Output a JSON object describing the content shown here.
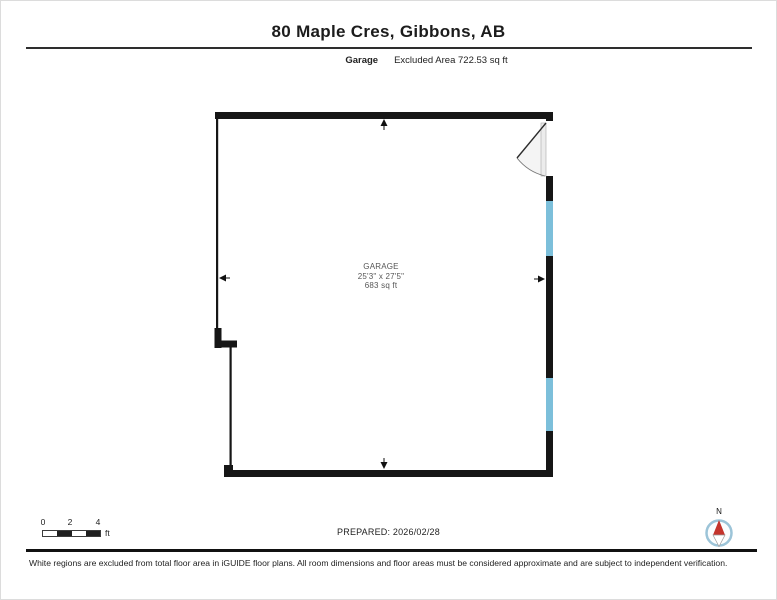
{
  "header": {
    "title": "80 Maple Cres, Gibbons, AB",
    "floor_label": "Garage",
    "area_note": "Excluded Area 722.53 sq ft"
  },
  "room": {
    "name": "GARAGE",
    "dimensions": "25'3\" x 27'5\"",
    "area": "683 sq ft"
  },
  "scale_bar": {
    "ticks": [
      "0",
      "2",
      "4"
    ],
    "unit": "ft"
  },
  "footer": {
    "prepared": "PREPARED: 2026/02/28",
    "disclaimer": "White regions are excluded from total floor area in iGUIDE floor plans. All room dimensions and floor areas must be considered approximate and are subject to independent verification."
  },
  "compass": {
    "north_label": "N"
  },
  "colors": {
    "wall": "#161616",
    "window_fill": "#7cbfda",
    "door_arc": "#777777",
    "compass_ring": "#9cc4d8",
    "compass_needle_north": "#c4342c"
  }
}
